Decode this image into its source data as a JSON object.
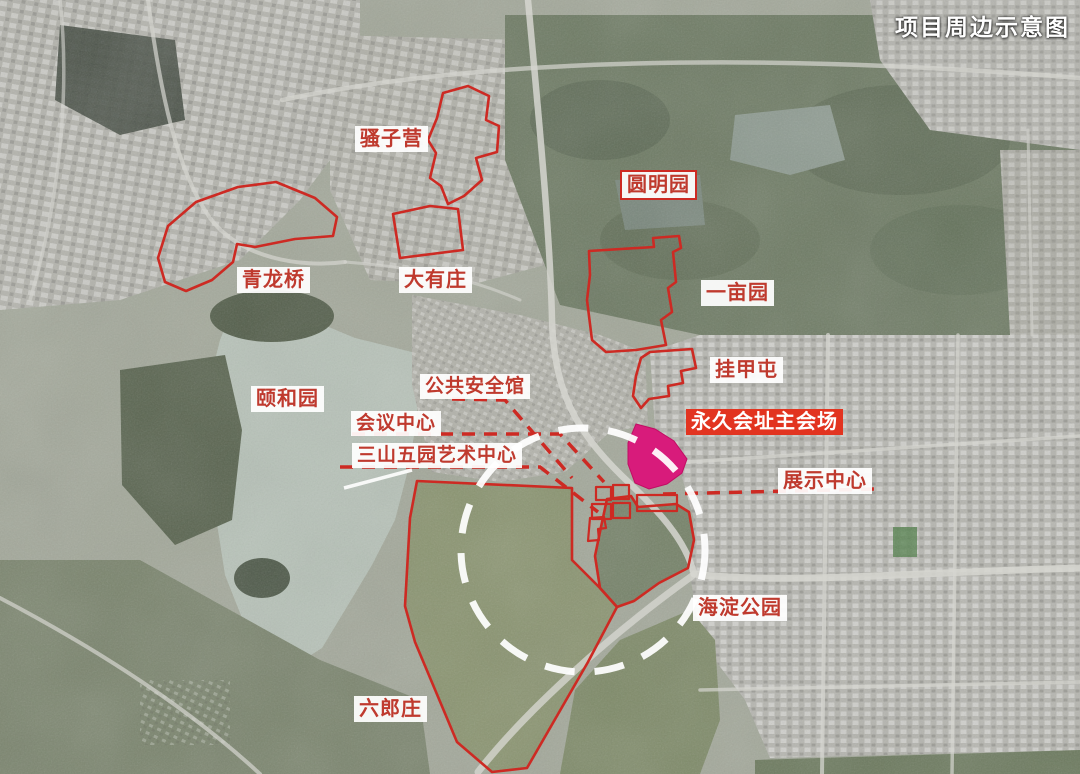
{
  "title": "项目周边示意图",
  "colors": {
    "boundary_red": "#cd2a23",
    "label_text_red": "#bf3a2e",
    "banner_red": "#e23420",
    "venue_magenta": "#d81b7b",
    "core_area_circle_white": "#ffffff"
  },
  "labels": [
    {
      "id": "saoziying",
      "text": "骚子营",
      "style": "plain"
    },
    {
      "id": "yuanmingyuan",
      "text": "圆明园",
      "style": "bordered"
    },
    {
      "id": "qinglongqiao",
      "text": "青龙桥",
      "style": "plain"
    },
    {
      "id": "dayouzhuang",
      "text": "大有庄",
      "style": "plain"
    },
    {
      "id": "yimuyuan",
      "text": "一亩园",
      "style": "plain"
    },
    {
      "id": "guajiatun",
      "text": "挂甲屯",
      "style": "plain"
    },
    {
      "id": "yiheyuan",
      "text": "颐和园",
      "style": "plain"
    },
    {
      "id": "gonggong_anquanguan",
      "text": "公共安全馆",
      "style": "plain"
    },
    {
      "id": "huiyi_zhongxin",
      "text": "会议中心",
      "style": "plain"
    },
    {
      "id": "sanshanwuyuan_art",
      "text": "三山五园艺术中心",
      "style": "plain"
    },
    {
      "id": "yongjiu_huizhi",
      "text": "永久会址主会场",
      "style": "banner"
    },
    {
      "id": "zhanshi_zhongxin",
      "text": "展示中心",
      "style": "plain"
    },
    {
      "id": "haidian_gongyuan",
      "text": "海淀公园",
      "style": "plain"
    },
    {
      "id": "liulangzhuang",
      "text": "六郎庄",
      "style": "plain"
    }
  ]
}
